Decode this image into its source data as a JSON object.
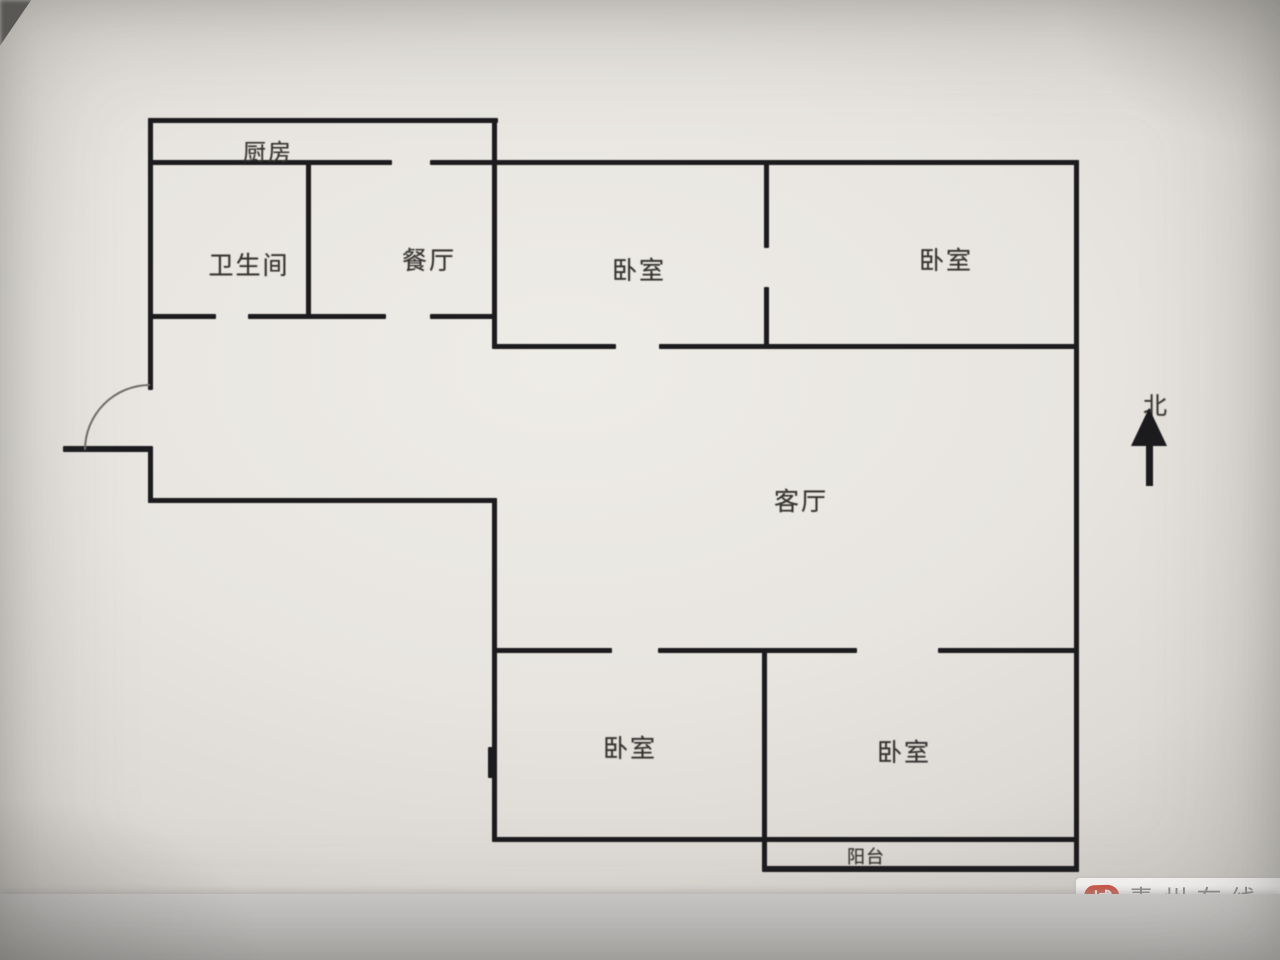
{
  "compass": {
    "label": "北"
  },
  "rooms": {
    "kitchen": {
      "label": "厨房"
    },
    "bathroom": {
      "label": "卫生间"
    },
    "dining": {
      "label": "餐厅"
    },
    "bedroom_top_left": {
      "label": "卧室"
    },
    "bedroom_top_right": {
      "label": "卧室"
    },
    "living": {
      "label": "客厅"
    },
    "bedroom_bottom_left": {
      "label": "卧室"
    },
    "bedroom_bottom_right": {
      "label": "卧室"
    },
    "balcony": {
      "label": "阳台"
    }
  },
  "watermark": {
    "seal_char_top": "城",
    "seal_char_bottom": "市",
    "site_name": "青州在线",
    "site_url": "www.0536qz.com",
    "seal_color": "#ce584a",
    "text_color": "#8c8b89"
  },
  "palette": {
    "wall_color": "#1c1b1e",
    "label_color": "#343230",
    "arc_color": "#6f6c68"
  },
  "floorplan": {
    "wall_thickness": 5,
    "walls": [
      [
        148,
        118,
        350,
        5
      ],
      [
        148,
        160,
        244,
        5
      ],
      [
        430,
        160,
        649,
        5
      ],
      [
        148,
        314,
        68,
        5
      ],
      [
        248,
        314,
        138,
        5
      ],
      [
        430,
        314,
        67,
        5
      ],
      [
        493,
        344,
        123,
        5
      ],
      [
        659,
        344,
        420,
        5
      ],
      [
        148,
        498,
        349,
        5
      ],
      [
        493,
        648,
        119,
        5
      ],
      [
        658,
        648,
        199,
        5
      ],
      [
        938,
        648,
        141,
        5
      ],
      [
        493,
        837,
        586,
        5
      ],
      [
        764,
        866,
        315,
        6
      ],
      [
        63,
        446,
        88,
        6
      ],
      [
        148,
        118,
        5,
        272
      ],
      [
        148,
        446,
        5,
        57
      ],
      [
        306,
        160,
        5,
        159
      ],
      [
        492,
        118,
        5,
        231
      ],
      [
        764,
        164,
        5,
        84
      ],
      [
        764,
        287,
        5,
        62
      ],
      [
        1074,
        160,
        5,
        712
      ],
      [
        492,
        498,
        5,
        344
      ],
      [
        488,
        747,
        9,
        31
      ],
      [
        762,
        648,
        5,
        224
      ]
    ]
  }
}
